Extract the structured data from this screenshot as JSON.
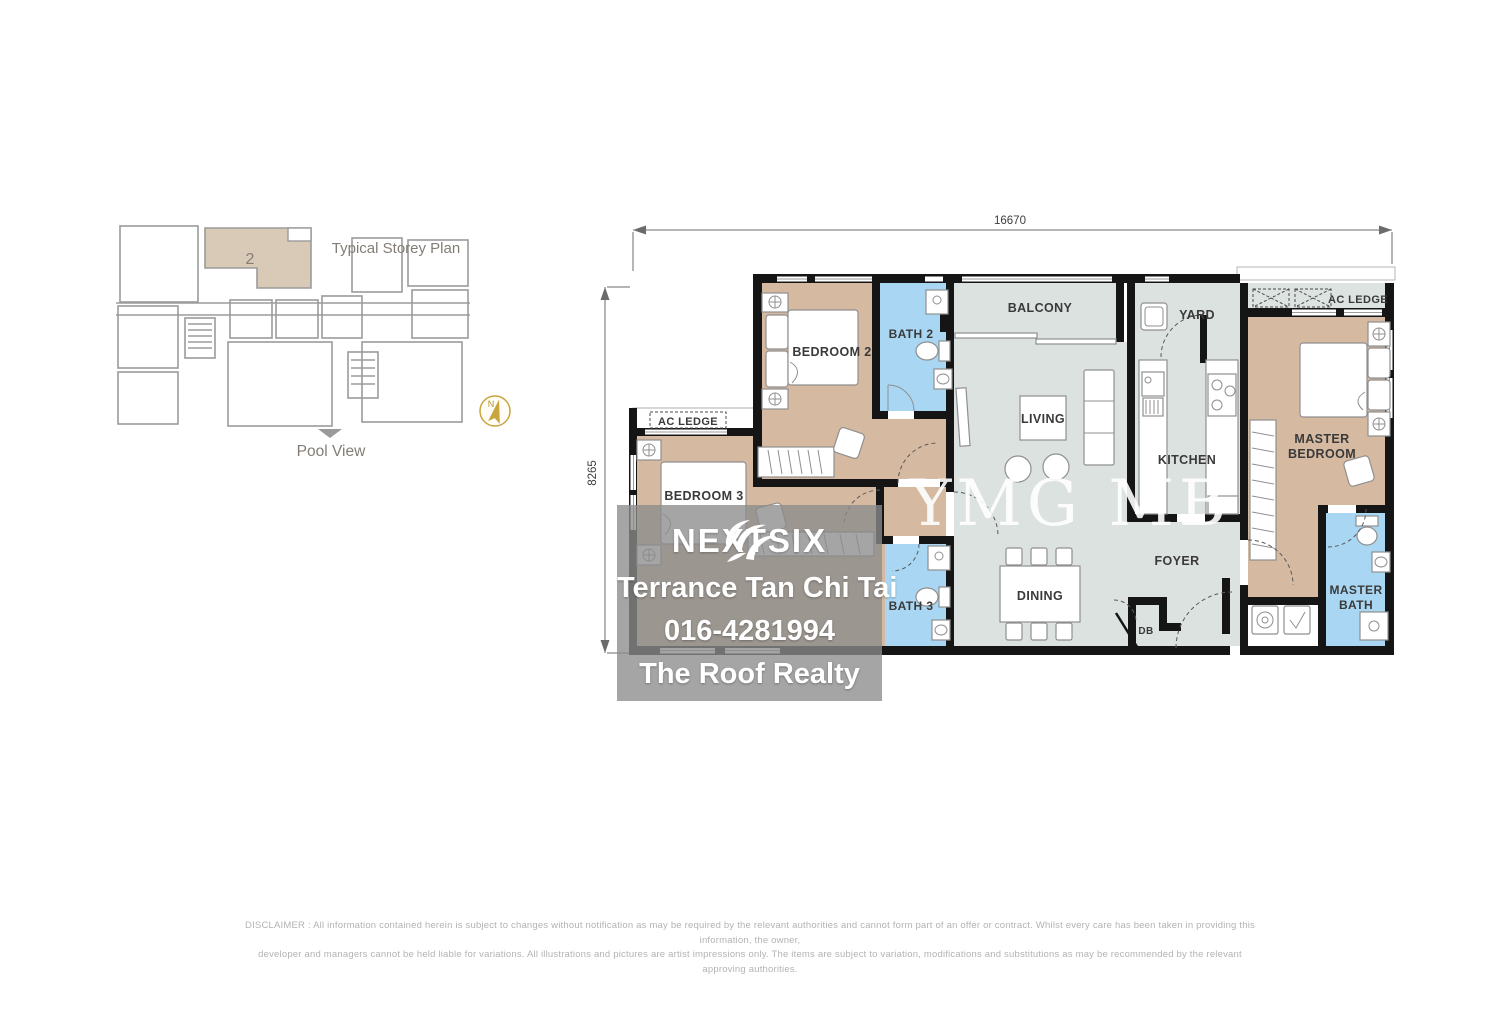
{
  "storey_plan": {
    "title": "Typical Storey Plan",
    "highlighted_unit": "2",
    "direction_label": "Pool View",
    "compass_north": "N"
  },
  "dimensions": {
    "width_mm": "16670",
    "depth_mm": "8265"
  },
  "rooms": {
    "bedroom2": "BEDROOM 2",
    "bath2": "BATH 2",
    "balcony": "BALCONY",
    "yard": "YARD",
    "ac_ledge_left": "AC LEDGE",
    "ac_ledge_right": "AC LEDGE",
    "living": "LIVING",
    "kitchen": "KITCHEN",
    "master_bedroom_line1": "MASTER",
    "master_bedroom_line2": "BEDROOM",
    "foyer": "FOYER",
    "dining": "DINING",
    "db": "DB",
    "bedroom3": "BEDROOM 3",
    "bath3": "BATH 3",
    "master_bath_line1": "MASTER",
    "master_bath_line2": "BATH"
  },
  "watermark": {
    "center_text": "YMG MB",
    "brand": "NEXTSIX",
    "agent_name": "Terrance Tan Chi Tai",
    "agent_phone": "016-4281994",
    "agent_company": "The Roof Realty"
  },
  "disclaimer": {
    "line1": "DISCLAIMER : All information contained herein is subject to changes without notification as may be required by the relevant authorities and cannot form part of an offer or contract. Whilst every care has been taken in providing this information, the owner,",
    "line2": "developer and managers cannot be held liable for variations. All illustrations and pictures are artist impressions only. The items are subject to variation, modifications and substitutions as may be recommended by the relevant approving authorities."
  },
  "colors": {
    "bedroom_fill": "#d5b9a1",
    "bath_fill": "#a9d7f3",
    "living_fill": "#dce2e0",
    "ac_ledge_fill": "#dde3e1",
    "wall": "#151515",
    "storey_unit_fill": "#d9cab7",
    "compass_gold": "#c3a23c"
  }
}
